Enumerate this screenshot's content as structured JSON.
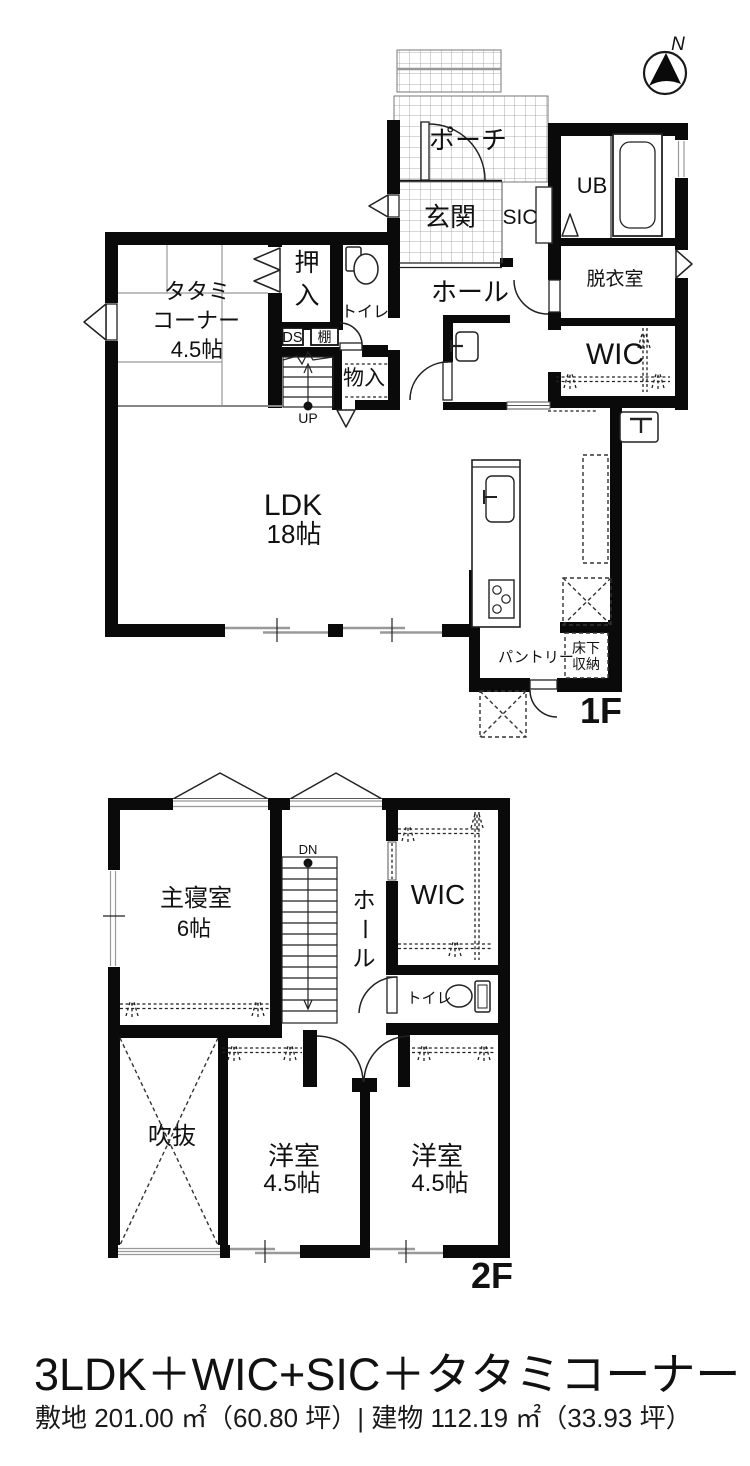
{
  "compass": {
    "north": "N"
  },
  "floor1": {
    "label": "1F",
    "porch": "ポーチ",
    "genkan": "玄関",
    "sic": "SIC",
    "ub": "UB",
    "datsui": "脱衣室",
    "hall": "ホール",
    "wic": "WIC",
    "oshiire_1": "押",
    "oshiire_2": "入",
    "toilet": "トイレ",
    "tatami_1": "タタミ",
    "tatami_2": "コーナー",
    "tatami_3": "4.5帖",
    "ds": "DS",
    "shelf": "棚",
    "monoire": "物入",
    "ldk_1": "LDK",
    "ldk_2": "18帖",
    "pantry": "パントリー",
    "underfloor_1": "床下",
    "underfloor_2": "収納",
    "up": "UP"
  },
  "floor2": {
    "label": "2F",
    "master_1": "主寝室",
    "master_2": "6帖",
    "hall_1": "ホ",
    "hall_2": "ー",
    "hall_3": "ル",
    "wic": "WIC",
    "toilet": "トイレ",
    "void": "吹抜",
    "west1_1": "洋室",
    "west1_2": "4.5帖",
    "west2_1": "洋室",
    "west2_2": "4.5帖",
    "dn": "DN"
  },
  "footer": {
    "title": "3LDK＋WIC+SIC＋タタミコーナー",
    "area": "敷地 201.00 ㎡（60.80 坪）| 建物 112.19 ㎡（33.93 坪）"
  },
  "colors": {
    "wall": "#0a0a0a",
    "bg": "#ffffff",
    "grid": "#999999"
  }
}
